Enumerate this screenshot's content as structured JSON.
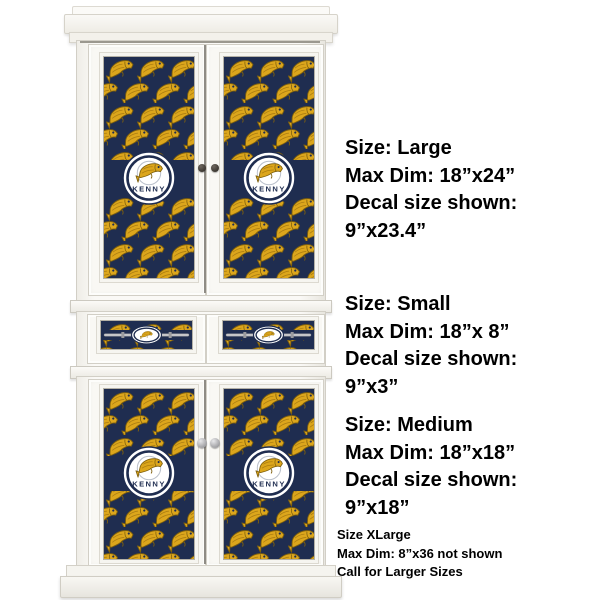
{
  "product": {
    "decal_name": "KENNY",
    "pattern_theme": "fish-pattern-decal",
    "colors": {
      "navy": "#1f2d50",
      "gold": "#dca61c",
      "gold_dark": "#7e5f0c",
      "gold_accent": "#a87a10",
      "badge_bg": "#ffffff",
      "badge_ring": "#1f2d50",
      "hook_circle": "#b9bfca",
      "silver": "#c8c8cb",
      "silver_dark": "#9b9b9e",
      "text": "#000000"
    }
  },
  "size_blocks": [
    {
      "id": "large",
      "lines": [
        "Size: Large",
        "Max Dim: 18”x24”",
        "Decal size shown:",
        "9”x23.4”"
      ]
    },
    {
      "id": "small",
      "lines": [
        "Size: Small",
        "Max Dim: 18”x 8”",
        "Decal size shown:",
        "9”x3”"
      ]
    },
    {
      "id": "medium",
      "lines": [
        "Size: Medium",
        "Max Dim: 18”x18”",
        "Decal size shown:",
        "9”x18”"
      ]
    },
    {
      "id": "xlarge",
      "lines": [
        "Size XLarge",
        "Max Dim: 8”x36 not shown",
        "Call for Larger Sizes"
      ]
    }
  ]
}
